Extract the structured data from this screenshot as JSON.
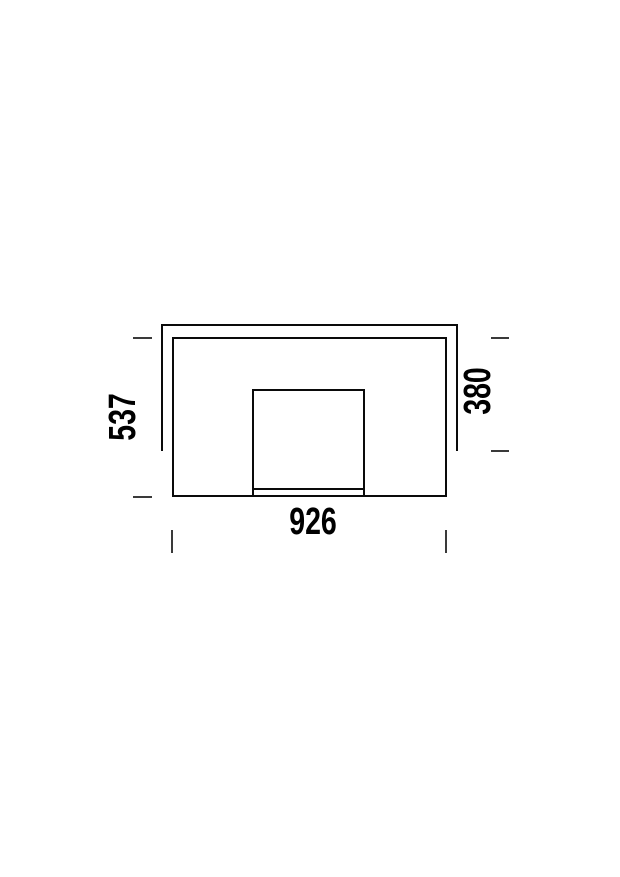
{
  "drawing": {
    "kind": "technical-dimension-drawing",
    "labels": {
      "left_height": "537",
      "right_height": "380",
      "bottom_width": "926"
    },
    "colors": {
      "line": "#0a0a0a",
      "tick": "#3a3a3a",
      "background": "#ffffff",
      "text": "#000000"
    }
  }
}
